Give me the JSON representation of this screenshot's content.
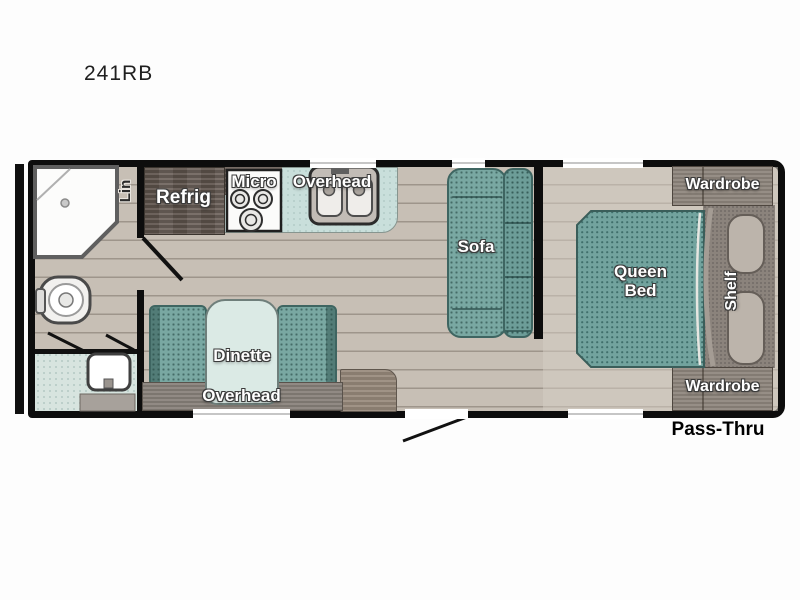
{
  "title": "241RB",
  "plan": {
    "bathroom": {
      "linen_label": "Lin"
    },
    "kitchen": {
      "refrigerator_label": "Refrig",
      "microwave_label": "Micro",
      "overhead_label": "Overhead"
    },
    "dinette": {
      "label": "Dinette",
      "overhead_label": "Overhead"
    },
    "living_area": {
      "sofa_label": "Sofa"
    },
    "bedroom": {
      "bed_label_line1": "Queen",
      "bed_label_line2": "Bed",
      "shelf_label": "Shelf",
      "wardrobe_front_label": "Wardrobe",
      "wardrobe_rear_label": "Wardrobe"
    },
    "exterior": {
      "pass_thru_label": "Pass-Thru"
    }
  },
  "colors": {
    "wall": "#0d0d0d",
    "floor": "#c7bfb5",
    "bath_floor": "#d7e4df",
    "counter": "#c9dfdb",
    "upholstery_teal": "#72a39e",
    "wood_dark": "#675c54",
    "wood_medium": "#90877e",
    "label_text": "#ffffff",
    "pass_thru_text": "#000000"
  }
}
